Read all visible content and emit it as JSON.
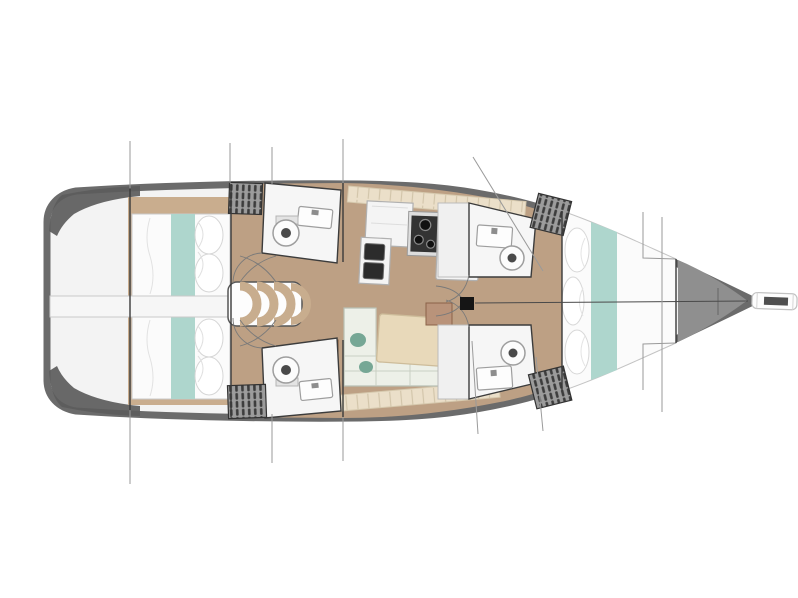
{
  "meta": {
    "title": "Sailboat interior layout floor plan, top view, bow pointing right",
    "diagram_type": "yacht-floor-plan"
  },
  "colors": {
    "background": "#ffffff",
    "hull_fill": "#f3f3f3",
    "deck_band": "#6b6b6b",
    "stern_shadow": "#5c5c5c",
    "bow_deck": "#8f8f8f",
    "floor": "#bda084",
    "floor_dark": "#c9ad8e",
    "bed_white": "#fbfbfb",
    "bed_teal": "#aed6cd",
    "room_white": "#f6f6f6",
    "shower_white": "#f0f0f0",
    "wall": "#3a3a3a",
    "locker_gray": "#9c9c9c",
    "locker_hatch": "#3d3d3d",
    "counter_white": "#f4f4f4",
    "stove_dark": "#333333",
    "sink_basin": "#2c2c2c",
    "sofa": "#edf0e8",
    "sofa_teal": "#76a795",
    "table_wood": "#e8d9ba",
    "trim_cream": "#ebdfc9",
    "box_brown": "#a97a55",
    "section_line": "#9a9a9a",
    "steps_tan": "#c8ad8e",
    "fixture_outline": "#9e9e9e",
    "walkway": "#f6f6f6"
  },
  "rooms": [
    {
      "id": "swim-platform",
      "label": "Transom / swim platform"
    },
    {
      "id": "aft-cabin-port",
      "label": "Aft double cabin (port)"
    },
    {
      "id": "aft-cabin-starboard",
      "label": "Aft double cabin (starboard)"
    },
    {
      "id": "companionway-steps",
      "label": "Companionway steps"
    },
    {
      "id": "aft-head-port",
      "label": "Aft head with toilet and sink (port)"
    },
    {
      "id": "aft-head-starboard",
      "label": "Aft head with toilet and sink (starboard)"
    },
    {
      "id": "galley",
      "label": "Galley with stove and double sink"
    },
    {
      "id": "salon",
      "label": "Salon with U-sofa and table"
    },
    {
      "id": "fwd-head-port",
      "label": "Forward head with toilet and sink (port)"
    },
    {
      "id": "fwd-head-starboard",
      "label": "Forward head with toilet and sink (starboard)"
    },
    {
      "id": "forward-cabin",
      "label": "Forward V-berth cabin"
    },
    {
      "id": "bow-locker",
      "label": "Bow / anchor locker"
    },
    {
      "id": "bowsprit",
      "label": "Bowsprit"
    },
    {
      "id": "mast",
      "label": "Mast foot"
    }
  ],
  "fixtures": [
    "toilet",
    "sink",
    "stove",
    "double-basin",
    "dining-table",
    "u-sofa",
    "double-bed",
    "v-berth",
    "steps",
    "hatched-locker"
  ]
}
